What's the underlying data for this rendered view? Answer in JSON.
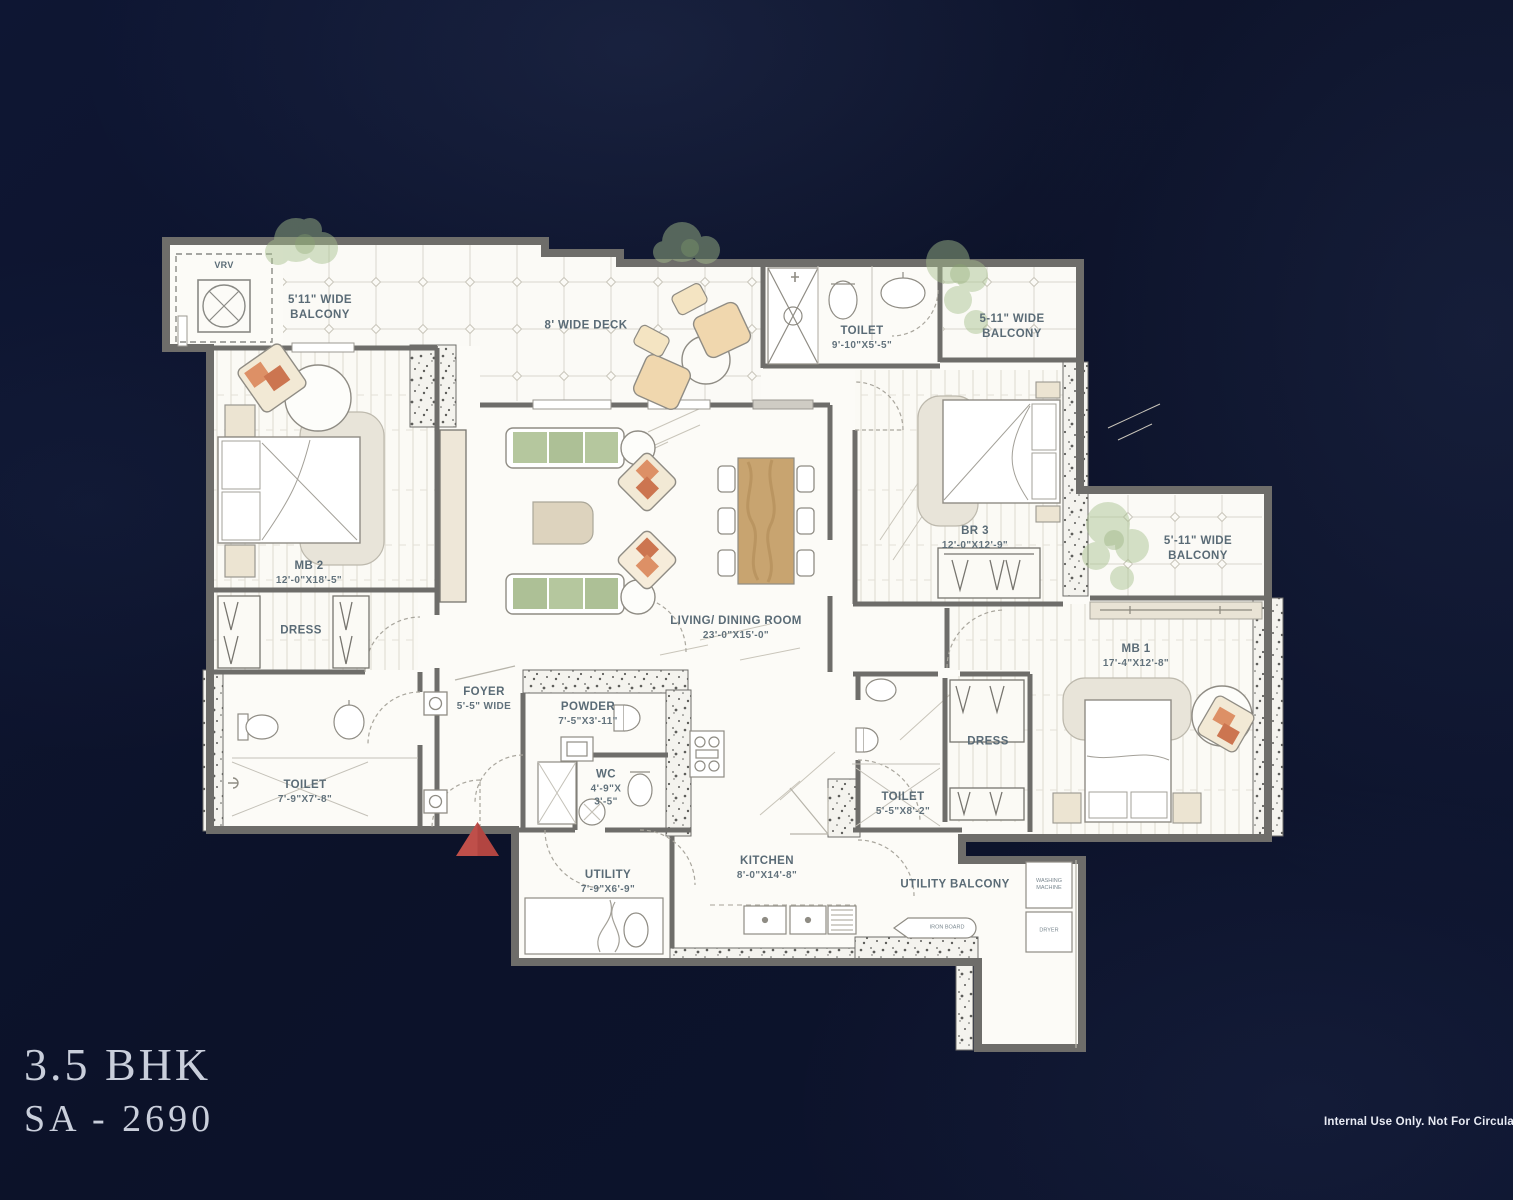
{
  "colors": {
    "background": "#0d1430",
    "floor": "#fcfbf7",
    "wall": "#6e6d6a",
    "label": "#5a6b76",
    "accent_red": "#bf4f4a",
    "sofa_green": "#b5c79e",
    "wood": "#c8a470",
    "title_text": "#c9cedb"
  },
  "title": {
    "bhk": "3.5 BHK",
    "sa": "SA - 2690"
  },
  "footer": {
    "note": "Internal Use Only. Not For Circulation"
  },
  "rooms": {
    "vrv": {
      "name": "VRV"
    },
    "balcony_tl": {
      "name": "5'11\" WIDE\nBALCONY"
    },
    "deck": {
      "name": "8' WIDE DECK"
    },
    "toilet_top": {
      "name": "TOILET",
      "dims": "9'-10\"X5'-5\""
    },
    "balcony_tr": {
      "name": "5-11\" WIDE\nBALCONY"
    },
    "br3": {
      "name": "BR 3",
      "dims": "12'-0\"X12'-9\""
    },
    "balcony_right": {
      "name": "5'-11\" WIDE\nBALCONY"
    },
    "mb1": {
      "name": "MB 1",
      "dims": "17'-4\"X12'-8\""
    },
    "mb2": {
      "name": "MB 2",
      "dims": "12'-0\"X18'-5\""
    },
    "dress_left": {
      "name": "DRESS"
    },
    "toilet_left": {
      "name": "TOILET",
      "dims": "7'-9\"X7'-8\""
    },
    "foyer": {
      "name": "FOYER",
      "dims": "5'-5\" WIDE"
    },
    "powder": {
      "name": "POWDER",
      "dims": "7'-5\"X3'-11\""
    },
    "wc": {
      "name": "WC",
      "dims": "4'-9\"X\n3'-5\""
    },
    "living_dining": {
      "name": "LIVING/ DINING ROOM",
      "dims": "23'-0\"X15'-0\""
    },
    "kitchen": {
      "name": "KITCHEN",
      "dims": "8'-0\"X14'-8\""
    },
    "utility": {
      "name": "UTILITY",
      "dims": "7'-9\"X6'-9\""
    },
    "toilet_right": {
      "name": "TOILET",
      "dims": "5'-5\"X8'-2\""
    },
    "dress_right": {
      "name": "DRESS"
    },
    "utility_balcony": {
      "name": "UTILITY BALCONY"
    },
    "washing_machine": {
      "name": "WASHING\nMACHINE"
    },
    "dryer": {
      "name": "DRYER"
    },
    "iron_board": {
      "name": "IRON BOARD"
    }
  }
}
